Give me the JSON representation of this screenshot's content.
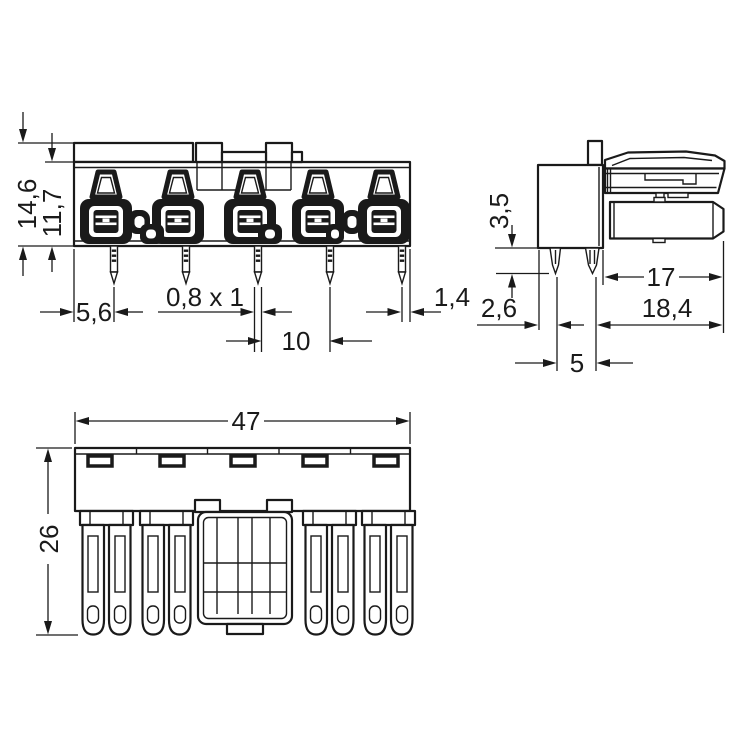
{
  "drawing": {
    "colors": {
      "line": "#1a1a1a",
      "background": "#ffffff"
    },
    "front_view": {
      "overall_height": "14,6",
      "housing_height": "11,7",
      "edge_to_first_pin": "5,6",
      "pin_cross_section": "0,8 x 1",
      "pin_pitch": "10",
      "last_pin_to_edge": "1,4"
    },
    "side_view": {
      "pin_length": "3,5",
      "edge_to_pin_row": "2,6",
      "pin_row_pitch": "5",
      "plug_section_length": "17",
      "overall_depth": "18,4"
    },
    "bottom_view": {
      "overall_width": "47",
      "overall_depth": "26"
    }
  }
}
